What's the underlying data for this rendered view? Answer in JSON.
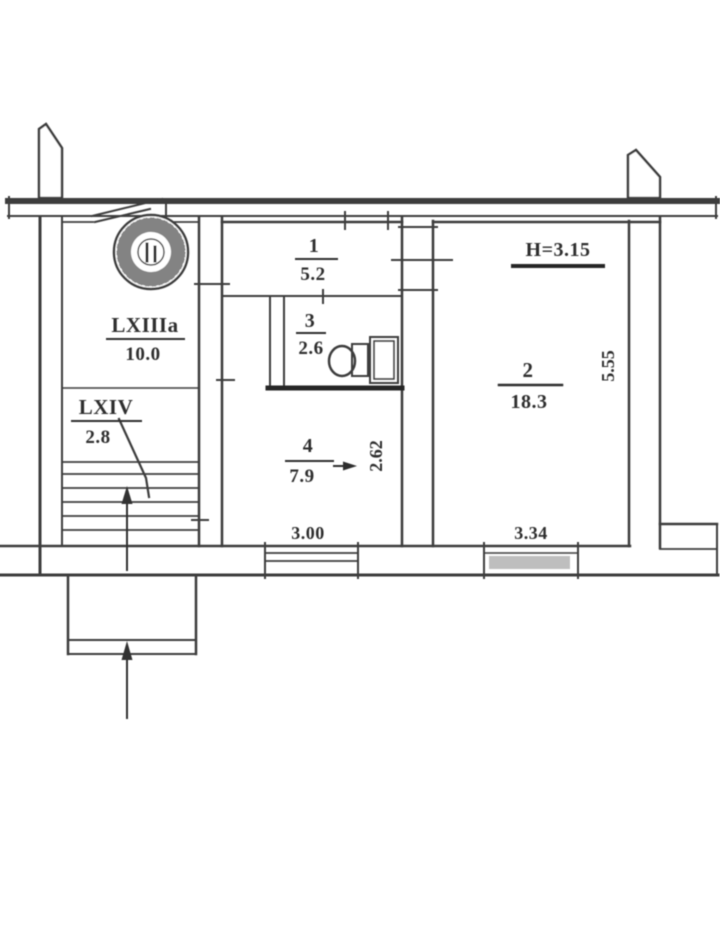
{
  "title": "apartment floor plan scan",
  "colors": {
    "background": "#ffffff",
    "line": "#3c3c3c",
    "line_dark": "#262626",
    "window_fill": "#9b9b9b"
  },
  "rooms": {
    "stairwell": {
      "label": "LXIIIa",
      "area": "10.0"
    },
    "vestibule": {
      "label": "LXIV",
      "area": "2.8"
    },
    "hall": {
      "label": "1",
      "area": "5.2"
    },
    "bathroom": {
      "label": "3",
      "area": "2.6"
    },
    "kitchen": {
      "label": "4",
      "area": "7.9"
    },
    "living_room": {
      "label": "2",
      "area": "18.3"
    }
  },
  "annotations": {
    "ceiling_height": "H=3.15"
  },
  "dimensions": {
    "kitchen_width": "3.00",
    "kitchen_depth": "2.62",
    "living_width": "3.34",
    "living_depth": "5.55"
  }
}
